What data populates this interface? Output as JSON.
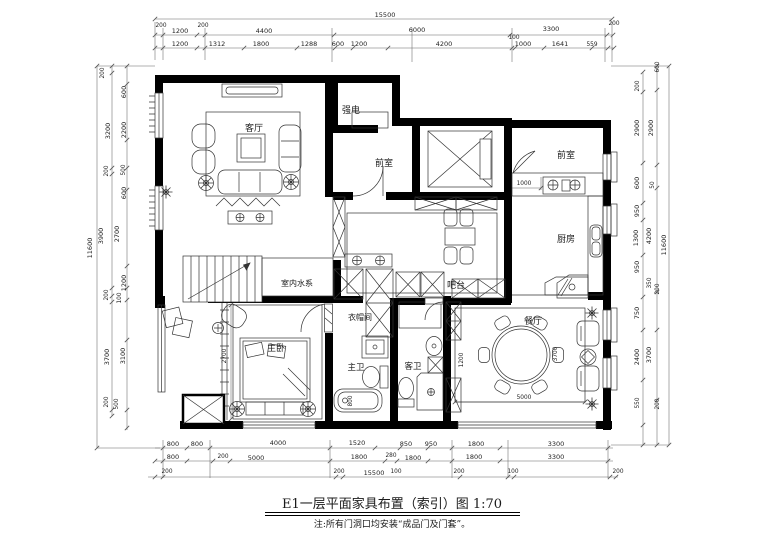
{
  "drawing": {
    "title": "E1一层平面家具布置（索引）图 1:70",
    "note": "注:所有门洞口均安装“成品门及门套”。"
  },
  "rooms": {
    "living": "客厅",
    "strong_electric": "强电",
    "vestibule_left": "前室",
    "vestibule_right": "前室",
    "kitchen": "厨房",
    "bar": "吧台",
    "water_feature": "室内水系",
    "master_bedroom": "主卧",
    "cloakroom": "衣帽间",
    "master_bath": "主卫",
    "guest_bath": "客卫",
    "dining": "餐厅"
  },
  "dims": {
    "top_total": "15500",
    "top_row2": [
      "200",
      "200",
      "1200",
      "4400",
      "6000",
      "3300",
      "200"
    ],
    "top_row3": [
      "1200",
      "1312",
      "1800",
      "1288",
      "600",
      "1200",
      "4200",
      "100",
      "1000",
      "1641",
      "559"
    ],
    "left": [
      "200",
      "600",
      "3200",
      "2200",
      "200",
      "500",
      "600",
      "3900",
      "2700",
      "11600",
      "1200",
      "200",
      "100",
      "3700",
      "3100",
      "200",
      "500"
    ],
    "right": [
      "600",
      "200",
      "2900",
      "2900",
      "600",
      "50",
      "950",
      "1300",
      "4200",
      "11600",
      "950",
      "350",
      "200",
      "750",
      "2400",
      "3700",
      "550",
      "200"
    ],
    "bottom_row1": [
      "800",
      "800",
      "4000",
      "1520",
      "850",
      "950",
      "1800",
      "3300"
    ],
    "bottom_row2": [
      "800",
      "200",
      "5000",
      "1800",
      "280",
      "1800",
      "1800",
      "3300"
    ],
    "bottom_row3": [
      "200",
      "200",
      "15500",
      "100",
      "200",
      "100",
      "200"
    ],
    "inner": {
      "kitchen_counter": "1000",
      "bedroom_width": "2700",
      "tub": "800",
      "dining_cabinet": "1200",
      "dining_depth": "3700",
      "dining_width": "5000"
    }
  }
}
